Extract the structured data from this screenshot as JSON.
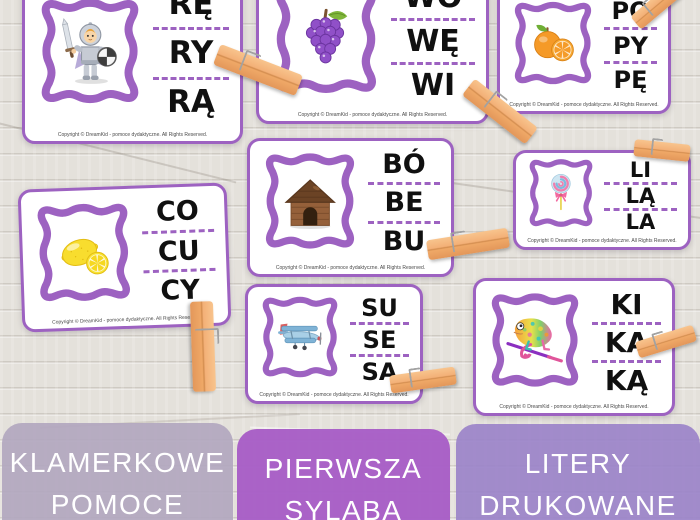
{
  "cards": [
    {
      "image": "knight",
      "syllables": [
        "RĘ",
        "RY",
        "RĄ"
      ]
    },
    {
      "image": "grapes",
      "syllables": [
        "WO",
        "WĘ",
        "WI"
      ]
    },
    {
      "image": "orange",
      "syllables": [
        "PO",
        "PY",
        "PĘ"
      ]
    },
    {
      "image": "lemon",
      "syllables": [
        "CO",
        "CU",
        "CY"
      ]
    },
    {
      "image": "doghouse",
      "syllables": [
        "BÓ",
        "BE",
        "BU"
      ]
    },
    {
      "image": "lollipop",
      "syllables": [
        "LI",
        "LĄ",
        "LA"
      ]
    },
    {
      "image": "biplane",
      "syllables": [
        "SU",
        "SE",
        "SA"
      ]
    },
    {
      "image": "chameleon",
      "syllables": [
        "KI",
        "KA",
        "KĄ"
      ]
    }
  ],
  "copyright_text": "Copyright ©  DreamKid - pomoce dydaktyczne. All Rights Reserved.",
  "tabs": [
    {
      "line1": "KLAMERKOWE",
      "line2": "POMOCE"
    },
    {
      "line1": "PIERWSZA",
      "line2": "SYLABA"
    },
    {
      "line1": "LITERY",
      "line2": "DRUKOWANE"
    }
  ],
  "colors": {
    "card_border": "#9d62c1",
    "dashed_line": "#9d62c1",
    "tab_klamerkowe_bg": "#b2a7bf",
    "tab_pierwsza_bg": "#a75ec6",
    "tab_litery_bg": "#9b83c9",
    "clothespin": "#f3b077",
    "wood_background": "#e4e1db"
  }
}
